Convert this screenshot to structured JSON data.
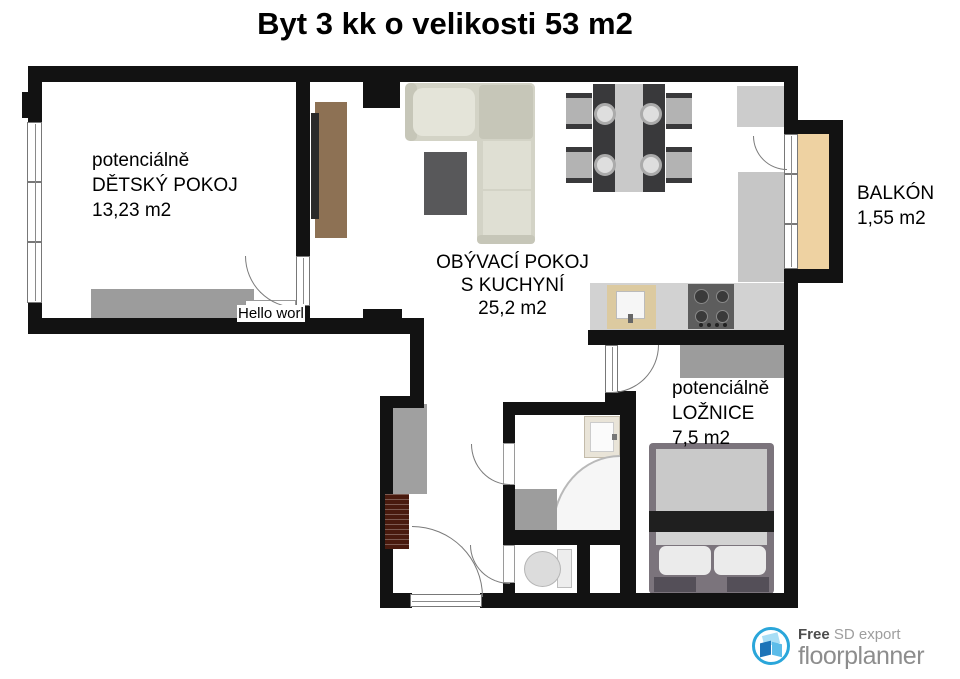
{
  "title": "Byt 3 kk o velikosti 53 m2",
  "rooms": {
    "detsky": {
      "prefix": "potenciálně",
      "name": "DĚTSKÝ POKOJ",
      "area": "13,23 m2"
    },
    "obyvaci": {
      "name": "OBÝVACÍ POKOJ",
      "name2": "S KUCHYNÍ",
      "area": "25,2 m2"
    },
    "balkon": {
      "name": "BALKÓN",
      "area": "1,55 m2"
    },
    "loznice": {
      "prefix": "potenciálně",
      "name": "LOŽNICE",
      "area": "7,5 m2"
    }
  },
  "annotation": "Hello worl",
  "footer": {
    "free_label": "Free",
    "export_label": "SD export",
    "brand": "floorplanner"
  },
  "colors": {
    "wall": "#121212",
    "balcony_floor": "#eed2a2",
    "wood_cabinet": "#8d7154",
    "furniture_gray": "#9c9c9c",
    "counter_gray": "#d2d2d2",
    "sofa_cream": "#d3d3c6",
    "brand_blue": "#2aa6da",
    "brand_gray": "#8d8d8d"
  }
}
